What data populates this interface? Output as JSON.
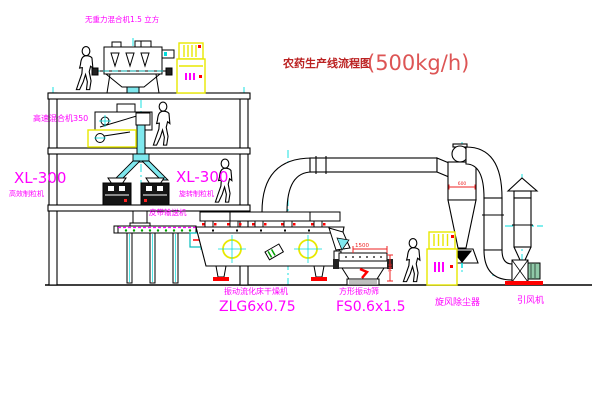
{
  "title": {
    "name": "农药生产线流程图",
    "capacity": "(500kg/h)"
  },
  "equipment_labels": {
    "gravity_mixer": "无重力混合机1.5 立方",
    "high_speed_mixer": "高速混合机350",
    "granulator_left_model": "XL-300",
    "granulator_left_name": "高效制粒机",
    "granulator_right_model": "XL-300",
    "granulator_right_name": "旋转制粒机",
    "belt_conveyor": "皮带输送机",
    "fluid_bed_dryer_name": "振动流化床干燥机",
    "fluid_bed_dryer_model": "ZLG6x0.75",
    "square_sieve_name": "方形振动筛",
    "square_sieve_model": "FS0.6x1.5",
    "cyclone": "旋风除尘器",
    "induced_draft_fan": "引风机"
  },
  "dimensions": {
    "sieve_length": "1500",
    "sieve_height": "740",
    "cyclone_diameter": "600"
  },
  "figures": {
    "worker_count": 4
  },
  "colors": {
    "line": "#000000",
    "label_magenta": "#ff00ff",
    "title_red": "#bb2222",
    "capacity_red": "#dd5555",
    "dimension_red": "#ee2222",
    "centerline_cyan": "#00dddd",
    "chute_cyan": "#7fe8ee",
    "cabinet_yellow": "#e8e800",
    "accent_red": "#ff0000",
    "motor_green": "#8fc9a8",
    "dot_green": "#00a000",
    "background": "#ffffff"
  }
}
